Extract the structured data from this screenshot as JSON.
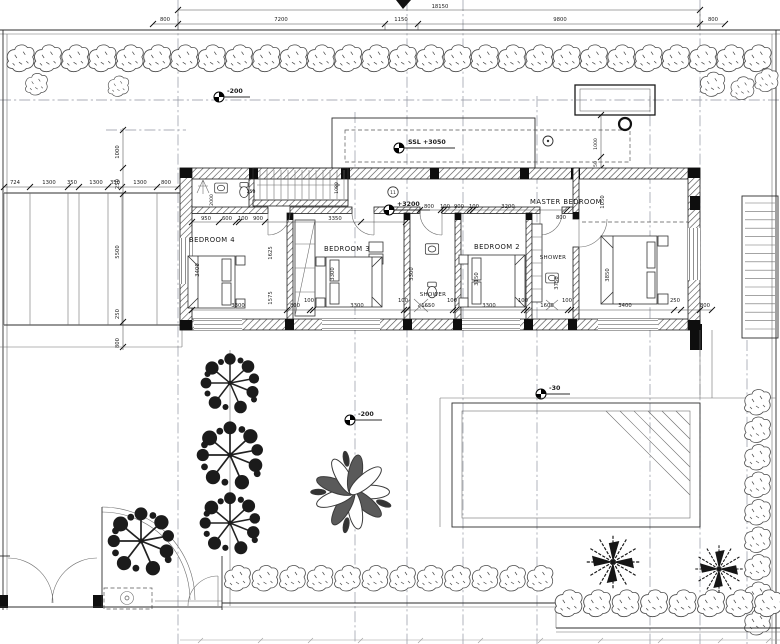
{
  "drawing": {
    "rooms": {
      "bedroom4": "BEDROOM 4",
      "bedroom3": "BEDROOM 3",
      "shower1": "SHOWER",
      "bedroom2": "BEDROOM 2",
      "shower2": "SHOWER",
      "master": "MASTER BEDROOM"
    },
    "levels": {
      "ssl": "SSL +3050",
      "floor": "+3200",
      "terrace": "-200",
      "garden": "-200",
      "pool": "-30"
    },
    "bubble": "11",
    "dims": {
      "total": "18150",
      "top": [
        "800",
        "7200",
        "1150",
        "9800",
        "800"
      ],
      "pergola": [
        "724",
        "1300",
        "350",
        "1300",
        "350",
        "1300",
        "800"
      ],
      "left_v": [
        "1000",
        "250",
        "5500",
        "250",
        "800"
      ],
      "hall": [
        "950",
        "600",
        "100",
        "900",
        "3350"
      ],
      "hall_right": [
        "800",
        "100",
        "900",
        "100",
        "3200",
        "800"
      ],
      "bottom": [
        "3300",
        "800",
        "100",
        "3300",
        "100",
        "1650",
        "100",
        "3300",
        "100",
        "1600",
        "100",
        "3400",
        "250",
        "800"
      ],
      "room_v": [
        "3400",
        "1625",
        "1575",
        "3300",
        "3300",
        "3150",
        "3750",
        "3850",
        "1050",
        "1080",
        "2000",
        "250",
        "1000",
        "50"
      ]
    }
  }
}
